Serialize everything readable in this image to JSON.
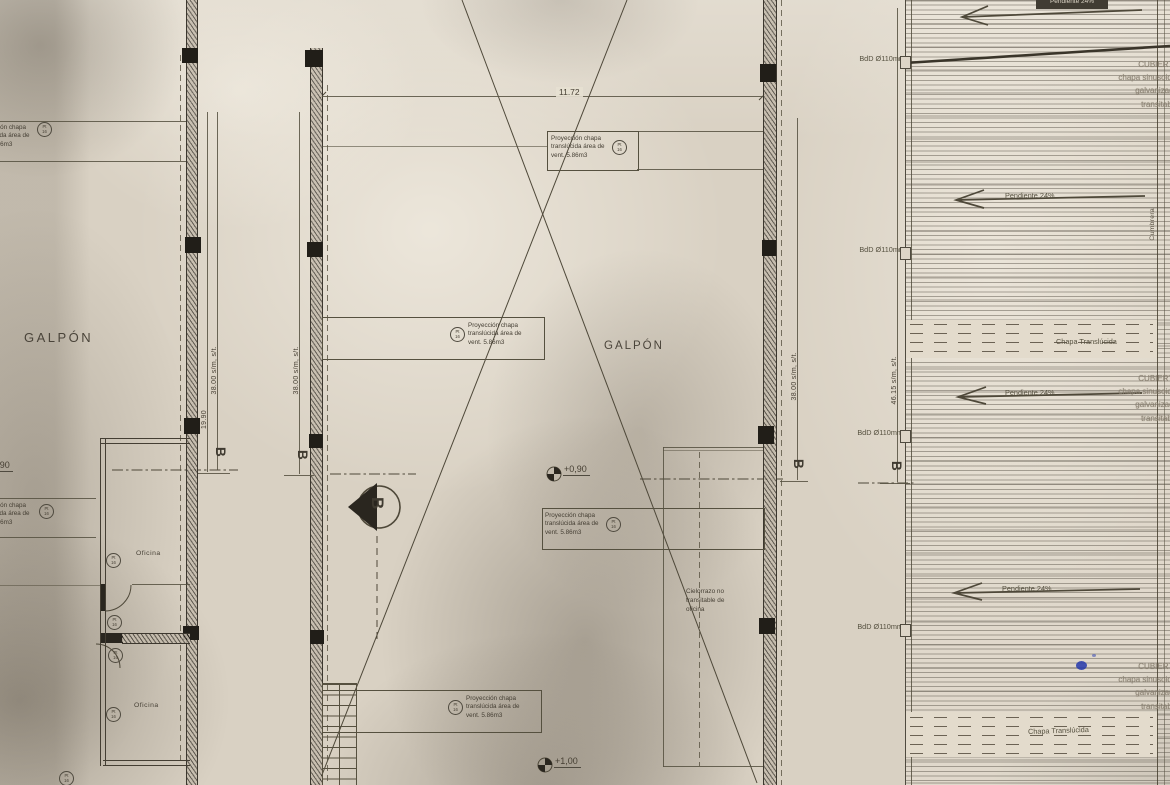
{
  "drawing": {
    "galpon_label": "GALPÓN",
    "dim_top": "11.72",
    "dim_19_90": "19.90",
    "dim_38": "38.00 s/m, s/t.",
    "dim_46": "46.15 s/m, s/t.",
    "section_letter": "B",
    "level_plus_090": "+0,90",
    "level_plus_100": "+1,00",
    "vent_note": "Proyección chapa translúcida área de vent. 5.86m3",
    "marker_line1": "Pt",
    "marker_line2": "16",
    "oficina_label": "Oficina",
    "cielorrazo_note": "Cielorrazo no transitable de oficina",
    "bdd_label": "BdD Ø110mm",
    "pendiente_label": "Pendiente 24%",
    "chapa_translucida_label": "Chapa Translúcida",
    "cumbrera_label": "Cumbrera",
    "cubierta_l1": "CUBIERTA",
    "cubierta_l2": "chapa sinusoidal",
    "cubierta_l3": "galvanizada",
    "cubierta_l4": "transitable"
  },
  "colors": {
    "paper": "#d9d1c3",
    "ink": "#463f33",
    "ink_dark": "#211e18",
    "blue_ink": "#2438ac"
  }
}
